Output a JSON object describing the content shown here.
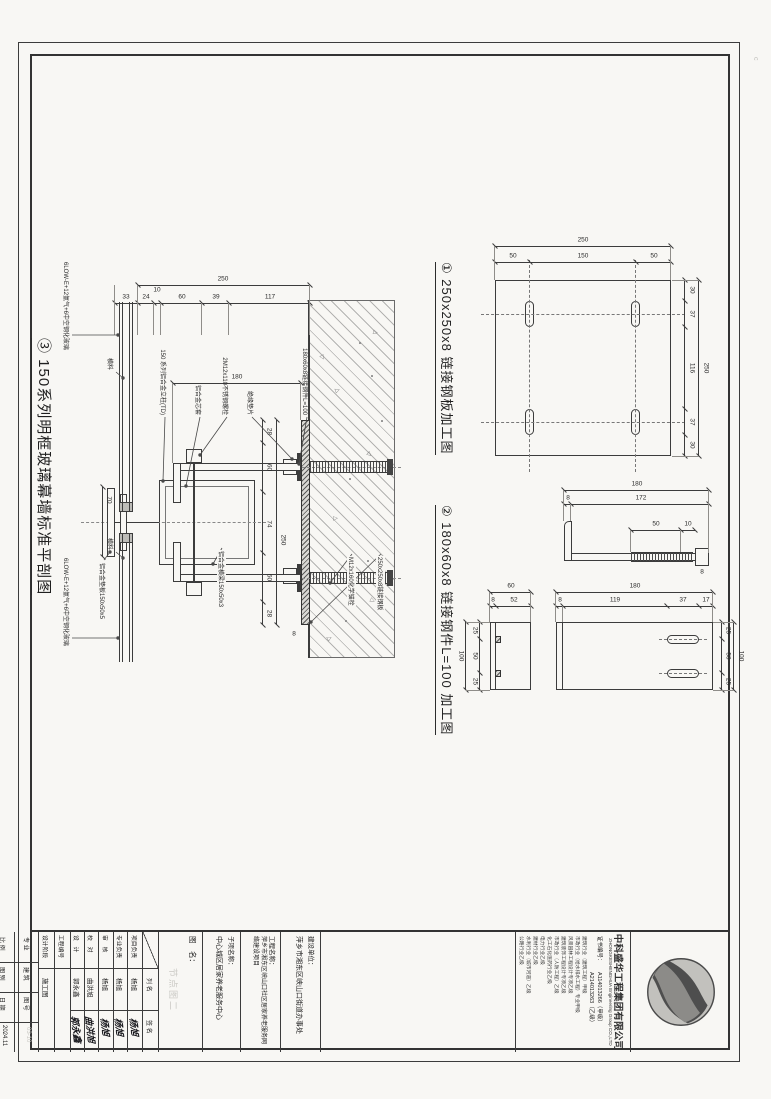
{
  "page": {
    "corner_mark": "c"
  },
  "detail1": {
    "title": "① 250x250x8 链接钢板加工图",
    "dim_overall_top": "250",
    "chain_top": [
      "30",
      "37",
      "116",
      "37",
      "30"
    ],
    "dim_overall_left": "250",
    "chain_left": [
      "50",
      "150",
      "50"
    ]
  },
  "detail2": {
    "title": "② 180x60x8 链接钢件L=100 加工图",
    "profile": {
      "overall": "180",
      "chain": [
        "8",
        "172"
      ],
      "rod": [
        "50",
        "10"
      ],
      "tip": "8"
    },
    "face": {
      "overall_len": "180",
      "chain_len": [
        "8",
        "119",
        "37",
        "17"
      ],
      "overall_w": "100",
      "chain_w": [
        "25",
        "50",
        "25"
      ]
    },
    "end": {
      "overall_w": "100",
      "chain_w": [
        "25",
        "50",
        "25"
      ],
      "overall_h": "60",
      "chain_h": [
        "8",
        "52"
      ]
    }
  },
  "detail3": {
    "title": "③ 150系列明框玻璃幕墙标准平剖图",
    "dim_overall_left": "250",
    "chain_left": [
      "117",
      "39",
      "60",
      "10",
      "24",
      "33"
    ],
    "dim_overall_h": "250",
    "chain_h": [
      "28",
      "60",
      "74",
      "60",
      "28"
    ],
    "dim_leg": "180",
    "dim_joint": "70",
    "dim_plate_t": "8",
    "labels": {
      "mullion": "150 系列铝合金立柱(TD)",
      "sleeve": "铝合金芯套",
      "bolt": "2M12x110不锈钢螺栓",
      "gasket": "绝缘垫片",
      "angle": "180x60x8链接钢件L=100",
      "plate": "250x250x8链接钢板",
      "anchor": "M12x160化学锚栓",
      "backplate": "铝合金垫板150x50x5",
      "transom_profile": "铝合金横梁150x50x3",
      "glass_left": "6LOW-E+12氩气+6中空钢化玻璃",
      "glass_right": "6LOW-E+12氩气+6中空钢化玻璃",
      "member_left": "横料",
      "member_right": "横料"
    }
  },
  "titleblock": {
    "company": {
      "name": "中科盛华工程集团有限公司",
      "name_en": "ZHONGKESHENGHUA Engineering Group CO.,LTD",
      "cert_label": "证书编号：",
      "cert1": "A114013266（甲级）",
      "cert2": "A214013263（乙级）",
      "quals": [
        "建筑行业（建筑工程）甲级",
        "市政行业（给水排水工程）专业甲级",
        "风景园林工程设计专项乙级",
        "建筑装饰工程设计专项乙级",
        "市政行业（人防工程）乙级",
        "化工石化医药行业乙级",
        "电力行业乙级",
        "建材行业乙级",
        "水利行业（城市河道）乙级",
        "公路行业乙级"
      ]
    },
    "owner_label": "建设单位：",
    "owner": "萍乡市湘东区峡山口街道办事处",
    "project_label": "工程名称：",
    "project": "萍乡市湘东区峡山口社区居家养老服务网络建设项目",
    "sub_label": "子项名称：",
    "sub": "中心城区居家养老服务中心",
    "drawing_label": "图　名：",
    "drawing_ghost": "节点图二",
    "sig": {
      "col_name": "列 名",
      "col_sign": "签 名",
      "rows": [
        {
          "role": "项目负责",
          "name": "杨旭",
          "sign": "杨旭"
        },
        {
          "role": "专业负责",
          "name": "杨旭",
          "sign": "杨旭"
        },
        {
          "role": "审　核",
          "name": "杨旭",
          "sign": "杨旭"
        },
        {
          "role": "校　对",
          "name": "曲洪旭",
          "sign": "曲洪旭"
        },
        {
          "role": "设　计",
          "name": "郭永鑫",
          "sign": "郭永鑫"
        }
      ]
    },
    "projno_label": "工程编号",
    "projno": "",
    "stage_label": "设计阶段",
    "stage": "施工图",
    "footer": {
      "major_label": "专 业",
      "major": "建 筑",
      "no_label": "图 号",
      "no": "03-10",
      "scale_label": "比 例",
      "scale": "",
      "type_label": "图 别",
      "date_label": "日 期",
      "date": "2024.11"
    }
  }
}
